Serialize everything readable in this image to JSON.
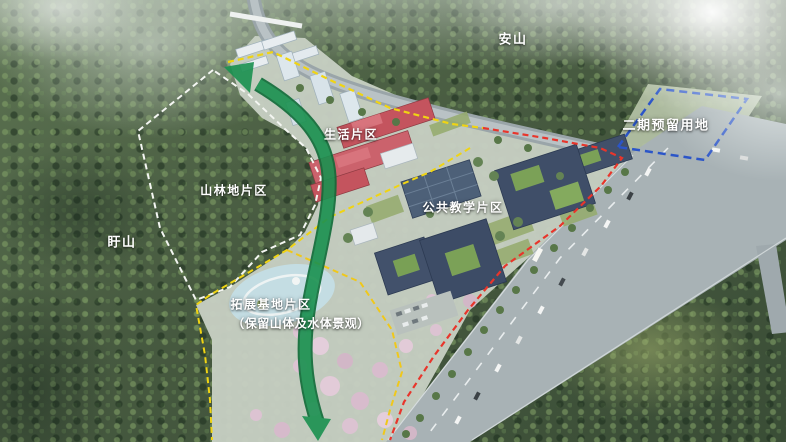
{
  "scene": {
    "type": "aerial campus masterplan rendering",
    "labels": {
      "mountain_top": "安山",
      "phase2_reserved": "二期预留用地",
      "living_zone": "生活片区",
      "forest_zone": "山林地片区",
      "mountain_left": "盱山",
      "teaching_zone": "公共教学片区",
      "base_zone": "拓展基地片区",
      "base_zone_note": "（保留山体及水体景观）"
    },
    "boundaries": [
      {
        "name": "forest-zone-boundary",
        "color": "#f4f6f2",
        "style": "dashed"
      },
      {
        "name": "campus-north-boundary",
        "color": "#f0d413",
        "style": "dashed"
      },
      {
        "name": "campus-road-boundary",
        "color": "#e8352b",
        "style": "dashed"
      },
      {
        "name": "inner-zone-boundary-west",
        "color": "#f0d413",
        "style": "dashed"
      },
      {
        "name": "inner-zone-boundary-east",
        "color": "#f0c81a",
        "style": "dashed"
      },
      {
        "name": "phase2-boundary",
        "color": "#2b55c8",
        "style": "dashed"
      }
    ],
    "axis_arrow": {
      "name": "green-landscape-axis",
      "color": "#1a9150",
      "edge": "#0f6b38"
    },
    "palette": {
      "forest": "#46593e",
      "road": "#a8b2b5",
      "campus_ground": "#c7cfc3",
      "pond": "#c4dde3",
      "blossom": "#dcc3d2",
      "red_building": "#c4545e",
      "dark_roof": "#3f4e68",
      "roof_garden": "#7ba157",
      "tower_wall": "#dde7ec",
      "lawn": "#95ab6c"
    }
  }
}
